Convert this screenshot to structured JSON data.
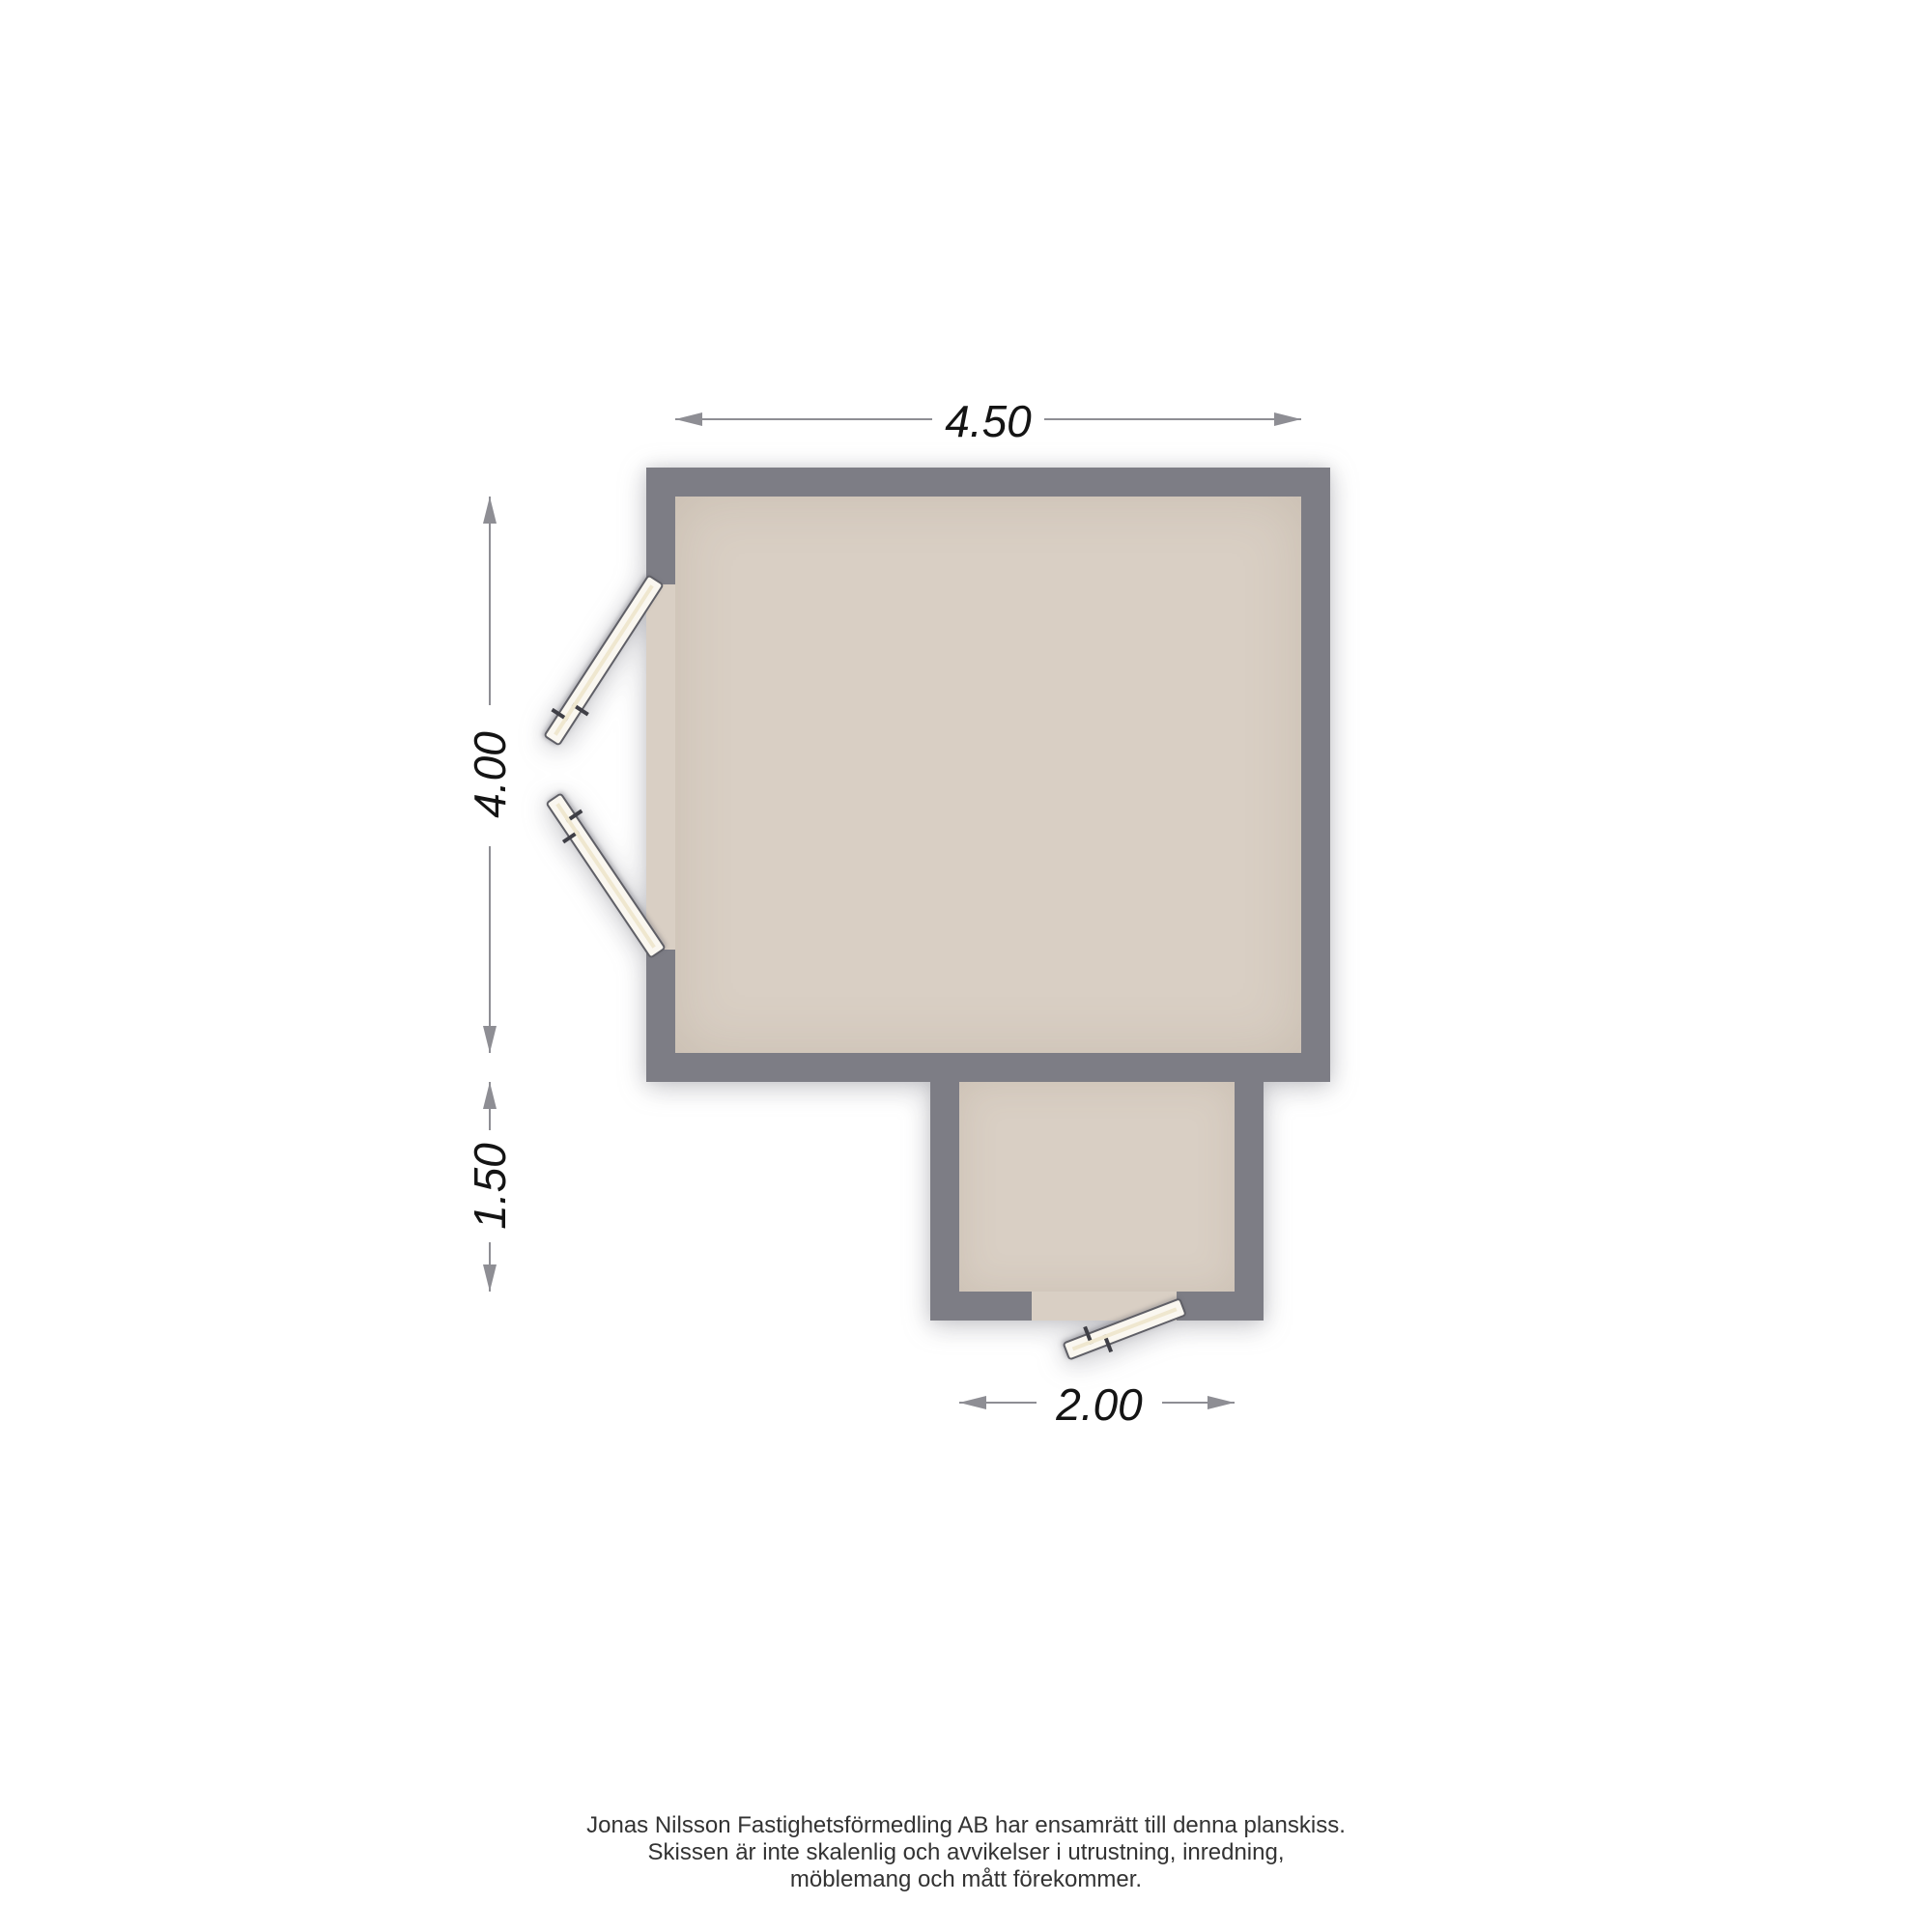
{
  "floorplan": {
    "type": "floor-plan-sketch",
    "dimensions": {
      "top": "4.50",
      "main_height": "4.00",
      "extension_height": "1.50",
      "extension_width": "2.00"
    },
    "features": {
      "doors": [
        "double-door-left-wall-upper-leaf",
        "double-door-left-wall-lower-leaf",
        "entry-door-extension-bottom"
      ],
      "rooms": [
        "main-room",
        "lower-extension"
      ]
    },
    "colors": {
      "background": "#ffffff",
      "wall": "#7d7d85",
      "floor": "#d9cfc4",
      "door": "#faf7f0",
      "dimension_line": "#8e8e94",
      "dimension_text": "#141414",
      "footer_text": "#333333"
    }
  },
  "footer": {
    "lines": [
      "Jonas Nilsson Fastighetsförmedling AB har ensamrätt till denna planskiss.",
      "Skissen är inte skalenlig och avvikelser i utrustning, inredning,",
      "möblemang och mått förekommer."
    ]
  }
}
